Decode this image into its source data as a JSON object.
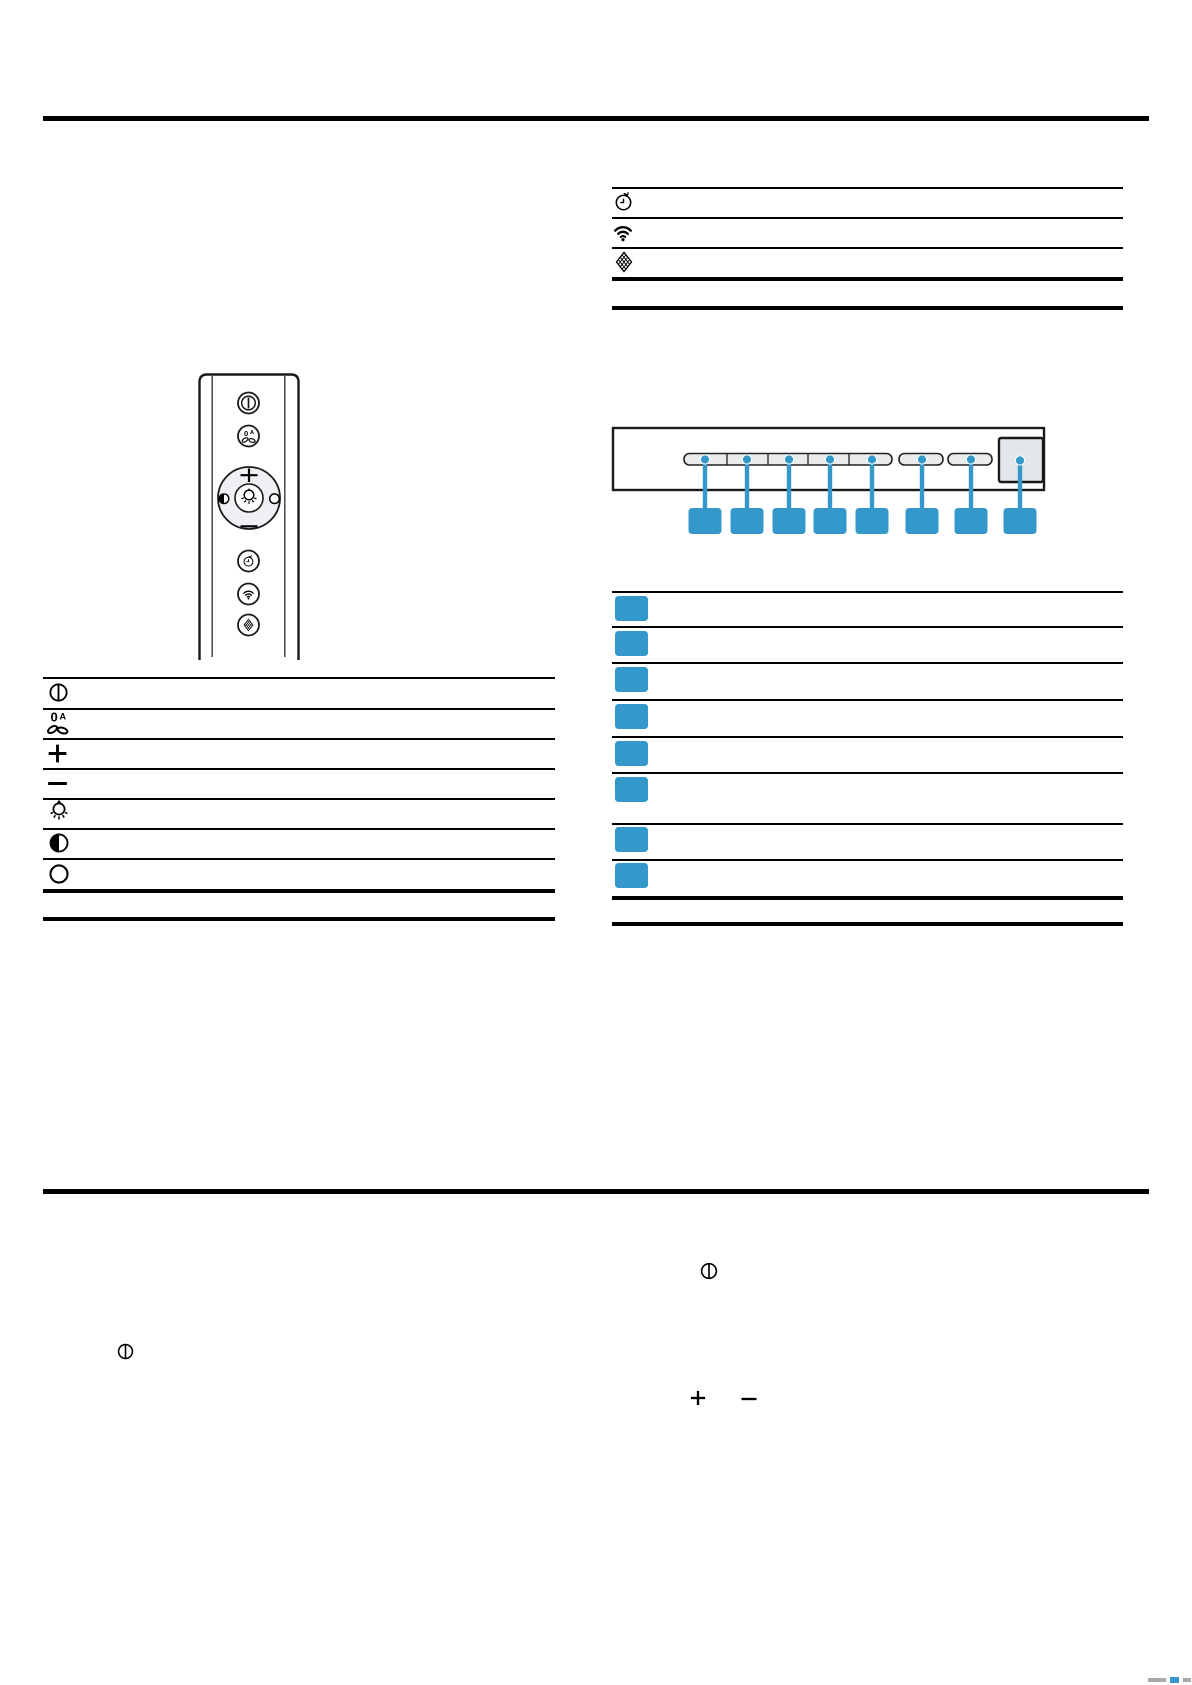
{
  "document": {
    "kind": "appliance-manual-page",
    "visible_text": ""
  },
  "colors": {
    "accent_blue": "#3498cb",
    "line_black": "#000000",
    "button_fill": "#e9ebec",
    "square_button_fill": "#e4e7ea",
    "remote_pad_fill": "#eef0f3",
    "footer_gray": "#a8a8a8"
  },
  "top_right_table": {
    "rows": [
      {
        "icon": "timer-icon",
        "label": ""
      },
      {
        "icon": "wifi-icon",
        "label": ""
      },
      {
        "icon": "mesh-filter-icon",
        "label": ""
      }
    ]
  },
  "remote_figure": {
    "description_icons": [
      "power-icon",
      "fan-auto-icon",
      "plus-icon",
      "contrast-icon",
      "light-icon",
      "circle-icon",
      "minus-icon",
      "timer-icon",
      "wifi-icon",
      "mesh-filter-icon"
    ]
  },
  "left_table": {
    "rows": [
      {
        "icon": "power-icon",
        "label": ""
      },
      {
        "icon": "fan-auto-icon",
        "label": ""
      },
      {
        "icon": "plus-icon",
        "label": ""
      },
      {
        "icon": "minus-icon",
        "label": ""
      },
      {
        "icon": "light-icon",
        "label": ""
      },
      {
        "icon": "contrast-icon",
        "label": ""
      },
      {
        "icon": "circle-icon",
        "label": ""
      }
    ]
  },
  "control_panel_figure": {
    "button_count": 8,
    "callout_count": 8,
    "callout_labels": [
      "",
      "",
      "",
      "",
      "",
      "",
      "",
      ""
    ]
  },
  "legend_table": {
    "rows": [
      {
        "marker": "callout-square",
        "label": ""
      },
      {
        "marker": "callout-square",
        "label": ""
      },
      {
        "marker": "callout-square",
        "label": ""
      },
      {
        "marker": "callout-square",
        "label": ""
      },
      {
        "marker": "callout-square",
        "label": ""
      },
      {
        "marker": "callout-square",
        "label": ""
      },
      {
        "marker": "callout-square",
        "label": ""
      },
      {
        "marker": "callout-square",
        "label": ""
      }
    ]
  },
  "body_inline_icons": [
    "power-icon",
    "power-icon",
    "plus-icon",
    "minus-icon"
  ]
}
